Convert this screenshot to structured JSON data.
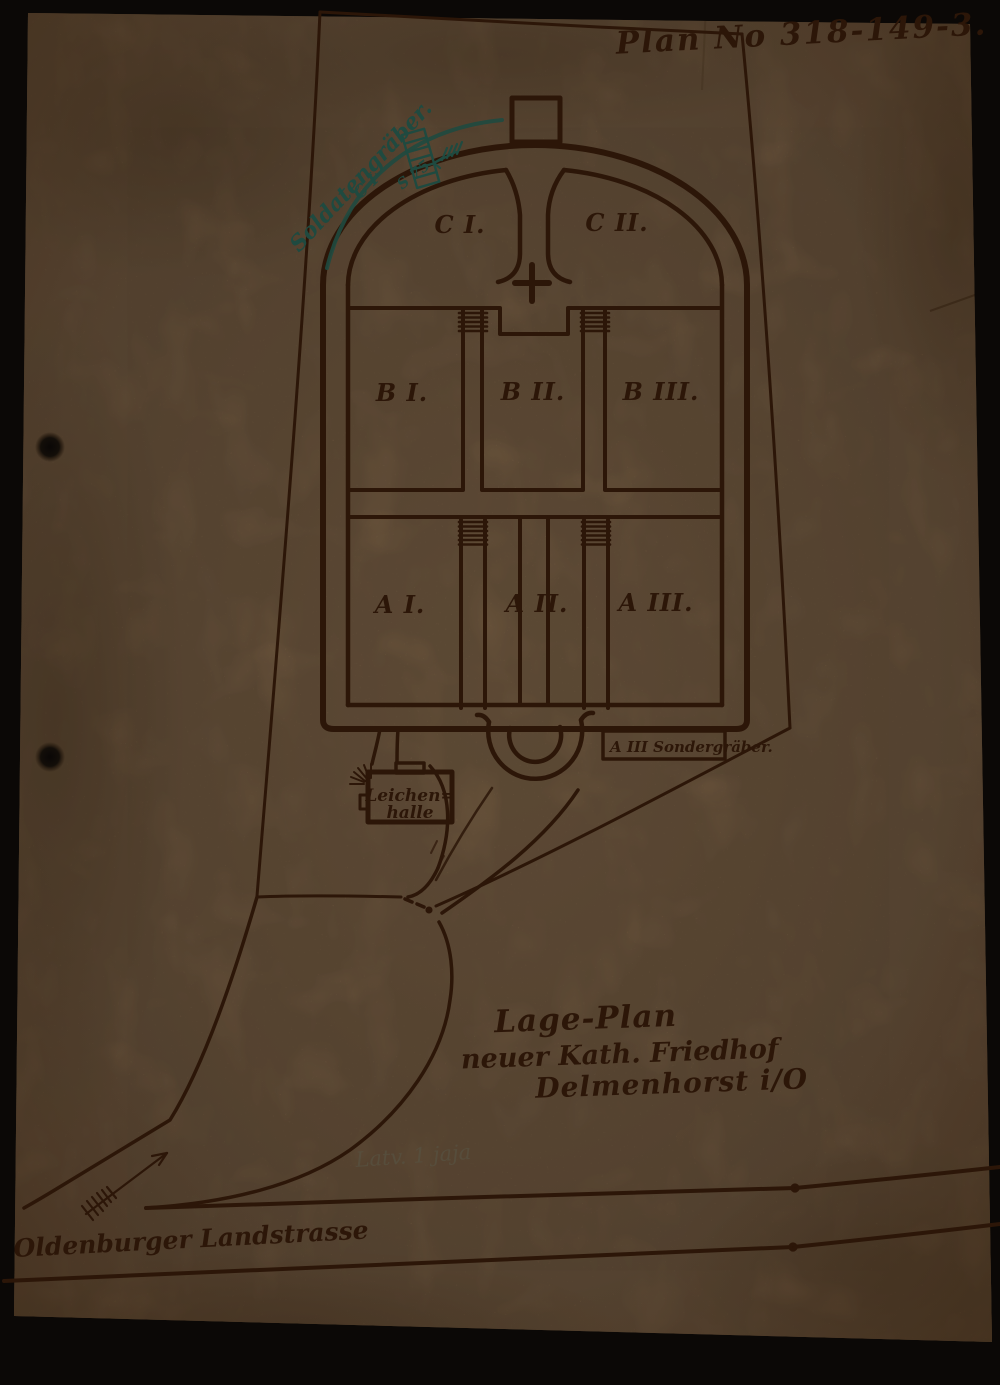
{
  "colors": {
    "background": "#0b0806",
    "paper": "#9b7a58",
    "ink": "#2c1608",
    "teal_ink": "#1f4a40",
    "pencil": "#57503f"
  },
  "plan_number": "Plan No 318-149-3.",
  "sections": {
    "c1": "C I.",
    "c2": "C II.",
    "b1": "B I.",
    "b2": "B II.",
    "b3": "B III.",
    "a1": "A I.",
    "a2": "A II.",
    "a3": "A III."
  },
  "annotations": {
    "soldier_graves": "Soldatengräber.",
    "soldier_graves_section": "C I",
    "soldier_graves_count": "S 75",
    "special_graves": "A III Sondergräber.",
    "mortuary_line1": "Leichen=",
    "mortuary_line2": "halle"
  },
  "title_block": {
    "line1": "Lage-Plan",
    "line2": "neuer Kath. Friedhof",
    "line3": "Delmenhorst i/O"
  },
  "pencil_note": "Latv. 1 jaja",
  "street_label": "Oldenburger Landstrasse"
}
